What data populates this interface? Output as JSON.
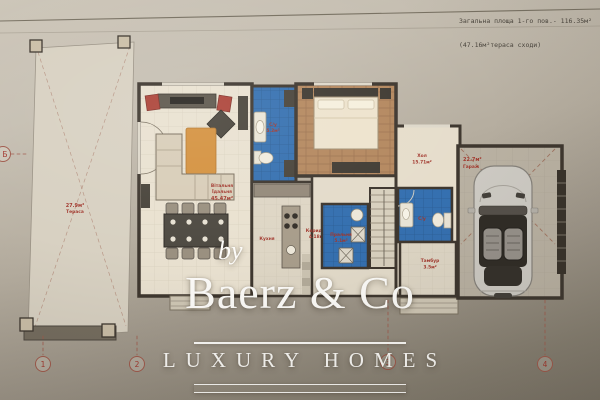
{
  "sheet_note": {
    "line1": "Загальна площа 1-го пов.- 116.35м²",
    "line2": "(47.16м²тераса сходи)"
  },
  "watermark": {
    "prefix": "by",
    "brand": "Baerz & Co",
    "tagline": "LUXURY HOMES"
  },
  "axis_markers": {
    "b1": "1",
    "b2": "2",
    "b3": "3",
    "b4": "4",
    "left": "Б"
  },
  "rooms": {
    "living": {
      "line1": "Вітальня",
      "line2": "Їдальня",
      "area": "45.47м²"
    },
    "kitchen": {
      "name": "Кухня"
    },
    "corridor": {
      "name": "Коридор",
      "area": "4.18м²"
    },
    "laundry": {
      "name": "Пральня",
      "area": "5.1м²"
    },
    "hall": {
      "name": "Хол",
      "area": "15.71м²"
    },
    "bath_top": {
      "name": "С/у",
      "area": "5.2м²"
    },
    "bath_hall": {
      "name": "С/у"
    },
    "vestibule": {
      "name": "Тамбур",
      "area": "3.5м²"
    },
    "garage": {
      "area": "22.7м²",
      "name": "Гараж"
    },
    "terrace": {
      "area": "27.9м²",
      "name": "Тераса"
    }
  },
  "colors": {
    "label_red": "#a2382e",
    "tile_blue": "#3570b0",
    "wall_dark": "#3e372f",
    "paper_light": "#cdc6b9",
    "paper_dark": "#7b7467",
    "watermark_white": "#fdfcf9"
  }
}
